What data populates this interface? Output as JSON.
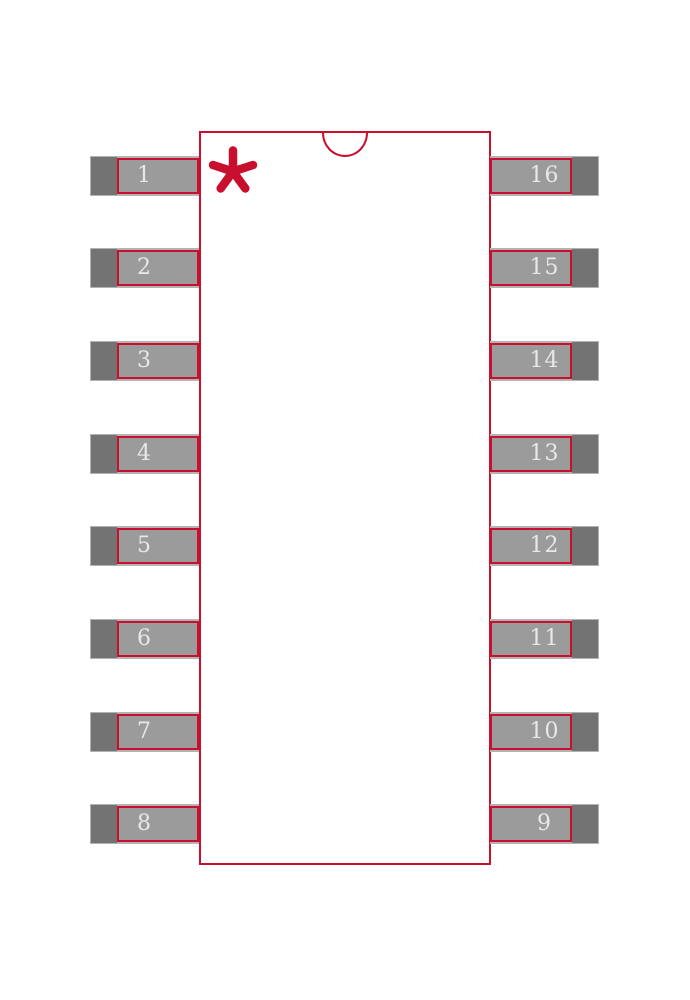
{
  "footprint": {
    "pads": {
      "left": [
        "1",
        "2",
        "3",
        "4",
        "5",
        "6",
        "7",
        "8"
      ],
      "right": [
        "16",
        "15",
        "14",
        "13",
        "12",
        "11",
        "10",
        "9"
      ]
    },
    "pin1_marker_icon": "asterisk-icon",
    "orientation_notch_icon": "half-circle-notch-icon",
    "colors": {
      "outline_red": "#c8102e",
      "pad_dark_gray": "#737373",
      "pad_light_gray": "#9b9b9b",
      "pad_outer_gray": "#b3b3b3",
      "pin_number_text": "#e8e8e8",
      "background": "#ffffff"
    }
  }
}
